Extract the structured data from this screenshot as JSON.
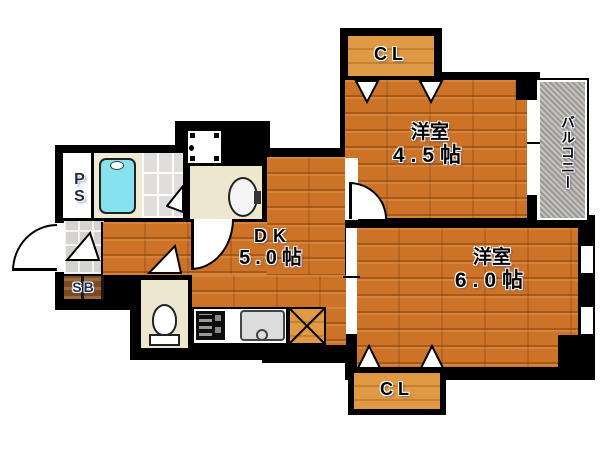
{
  "plan_title": "apartment-floor-plan",
  "rooms": {
    "closet_top": {
      "label": "CL"
    },
    "closet_bottom": {
      "label": "CL"
    },
    "western_room_45": {
      "name": "洋室",
      "size": "4.5帖"
    },
    "western_room_60": {
      "name": "洋室",
      "size": "6.0帖"
    },
    "dining_kitchen": {
      "name": "DK",
      "size": "5.0帖"
    },
    "balcony": {
      "label": "バルコニー"
    },
    "pipe_space": {
      "label": "PS"
    },
    "shoe_box": {
      "label": "SB"
    }
  },
  "fixtures": {
    "bathtub": "bathtub-icon",
    "toilet": "toilet-icon",
    "wash_basin": "wash-basin-icon",
    "washing_machine_pan": "washing-machine-pan-icon",
    "stove": "stove-icon",
    "kitchen_sink": "kitchen-sink-icon",
    "refrigerator_space": "refrigerator-x-icon",
    "doors": "door-swing-arc-icon",
    "closet_doors": "folding-door-triangle-icon"
  },
  "colors": {
    "wall": "#000000",
    "wood_floor": "#cd7328",
    "closet_wood": "#e09a44",
    "bath_cream": "#efead4",
    "utility_cream": "#ece7cd",
    "bath_tile": "#e0dedc",
    "entry_tile": "#d5d3cf",
    "balcony_gray": "#b2afaa",
    "bathtub_cyan": "#85e2ee",
    "shoe_box_brown": "#7b4b24"
  }
}
